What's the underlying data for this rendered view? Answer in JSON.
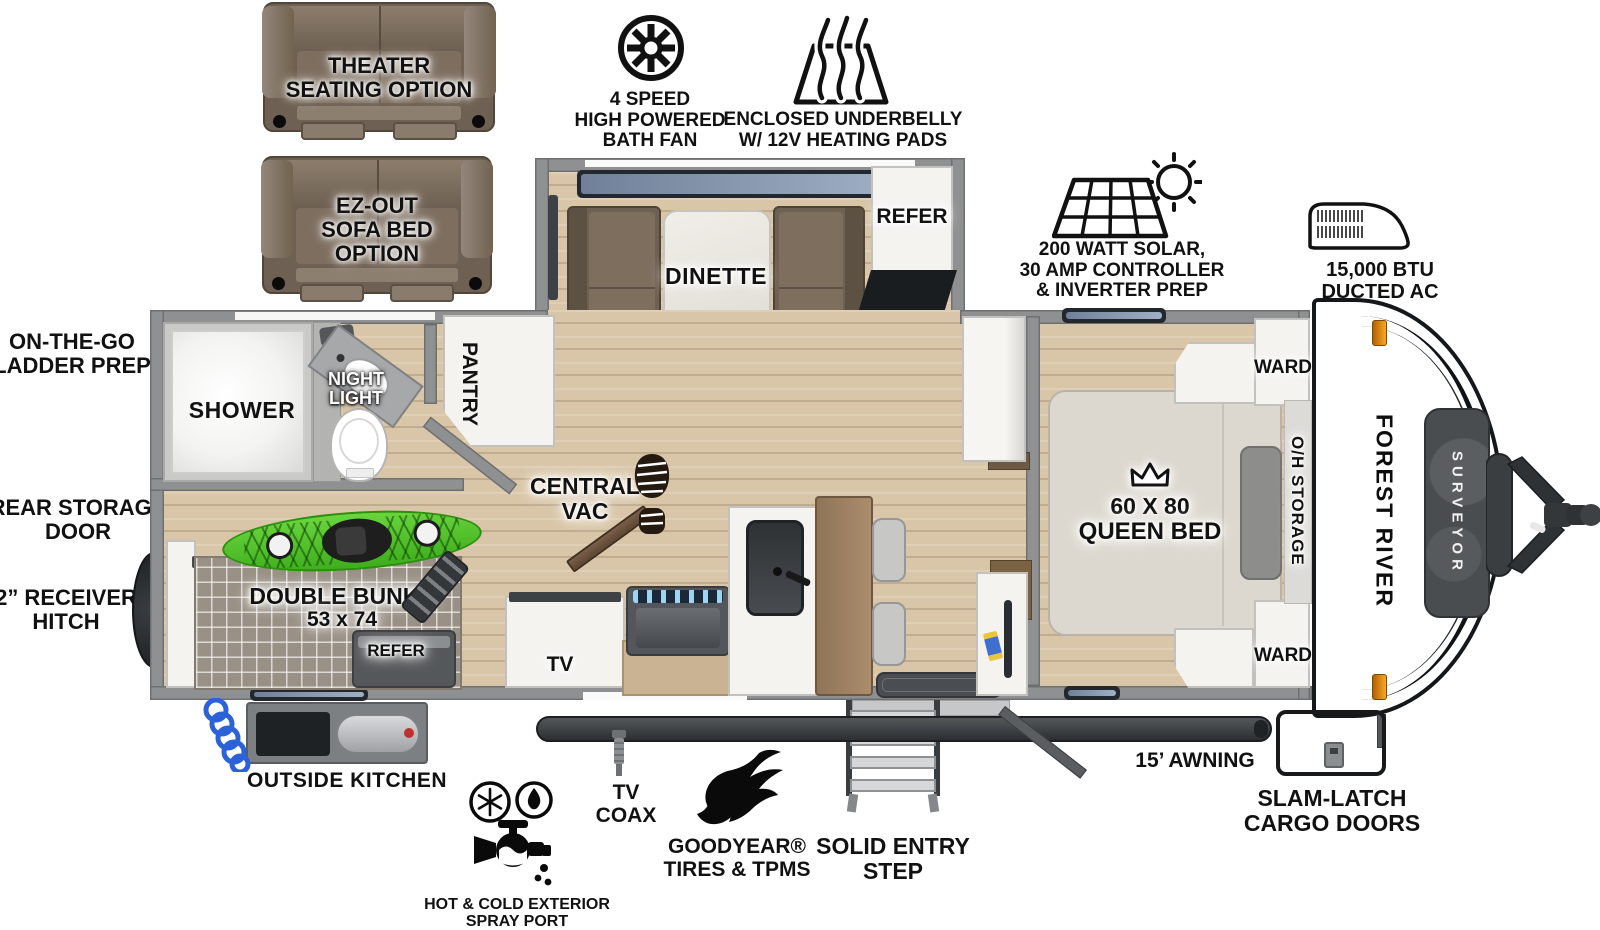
{
  "colors": {
    "floor_wood": "#d9c6a8",
    "wall_gray": "#8f9092",
    "kayak_green": "#55c62f",
    "marker_orange": "#f5a928",
    "rock_guard_gray": "#4a4d4f",
    "counter_brown": "#9a7f60",
    "window_blue": "#8ba0bf"
  },
  "options": {
    "theater": {
      "lines": [
        "THEATER",
        "SEATING OPTION"
      ]
    },
    "sofa_bed": {
      "lines": [
        "EZ-OUT",
        "SOFA BED",
        "OPTION"
      ]
    }
  },
  "callouts": {
    "bath_fan": {
      "lines": [
        "4 SPEED",
        "HIGH POWERED",
        "BATH FAN"
      ]
    },
    "underbelly": {
      "lines": [
        "ENCLOSED UNDERBELLY",
        "W/ 12V HEATING PADS"
      ]
    },
    "solar": {
      "lines": [
        "200 WATT SOLAR,",
        "30 AMP CONTROLLER",
        "& INVERTER PREP"
      ]
    },
    "ducted_ac": {
      "lines": [
        "15,000 BTU",
        "DUCTED AC"
      ]
    },
    "ladder_prep": {
      "lines": [
        "ON-THE-GO",
        "LADDER PREP"
      ]
    },
    "rear_storage": {
      "lines": [
        "REAR STORAGE",
        "DOOR"
      ]
    },
    "receiver_hitch": {
      "lines": [
        "2” RECEIVER",
        "HITCH"
      ]
    },
    "spray_port": {
      "lines": [
        "HOT & COLD EXTERIOR",
        "SPRAY PORT"
      ]
    },
    "tv_coax": {
      "lines": [
        "TV",
        "COAX"
      ]
    },
    "goodyear": {
      "lines": [
        "GOODYEAR®",
        "TIRES & TPMS"
      ]
    },
    "entry_step": {
      "lines": [
        "SOLID ENTRY",
        "STEP"
      ]
    },
    "awning": {
      "label": "15’ AWNING"
    },
    "cargo_doors": {
      "lines": [
        "SLAM-LATCH",
        "CARGO DOORS"
      ]
    },
    "outside_kitchen": {
      "label": "OUTSIDE KITCHEN"
    }
  },
  "interior": {
    "dinette": "DINETTE",
    "refer_main": "REFER",
    "pantry": "PANTRY",
    "shower": "SHOWER",
    "night_light": {
      "lines": [
        "NIGHT",
        "LIGHT"
      ]
    },
    "central_vac": {
      "lines": [
        "CENTRAL",
        "VAC"
      ]
    },
    "tv": "TV",
    "queen_bed": {
      "lines": [
        "60 X 80",
        "QUEEN BED"
      ]
    },
    "ward_front": "WARD",
    "ward_rear": "WARD",
    "oh_storage": "O/H STORAGE",
    "double_bunks": {
      "lines": [
        "DOUBLE BUNKS",
        "53 x 74"
      ]
    },
    "refer_bunk": "REFER"
  },
  "brand": {
    "manufacturer": "FOREST RIVER",
    "model": "SURVEYOR"
  }
}
